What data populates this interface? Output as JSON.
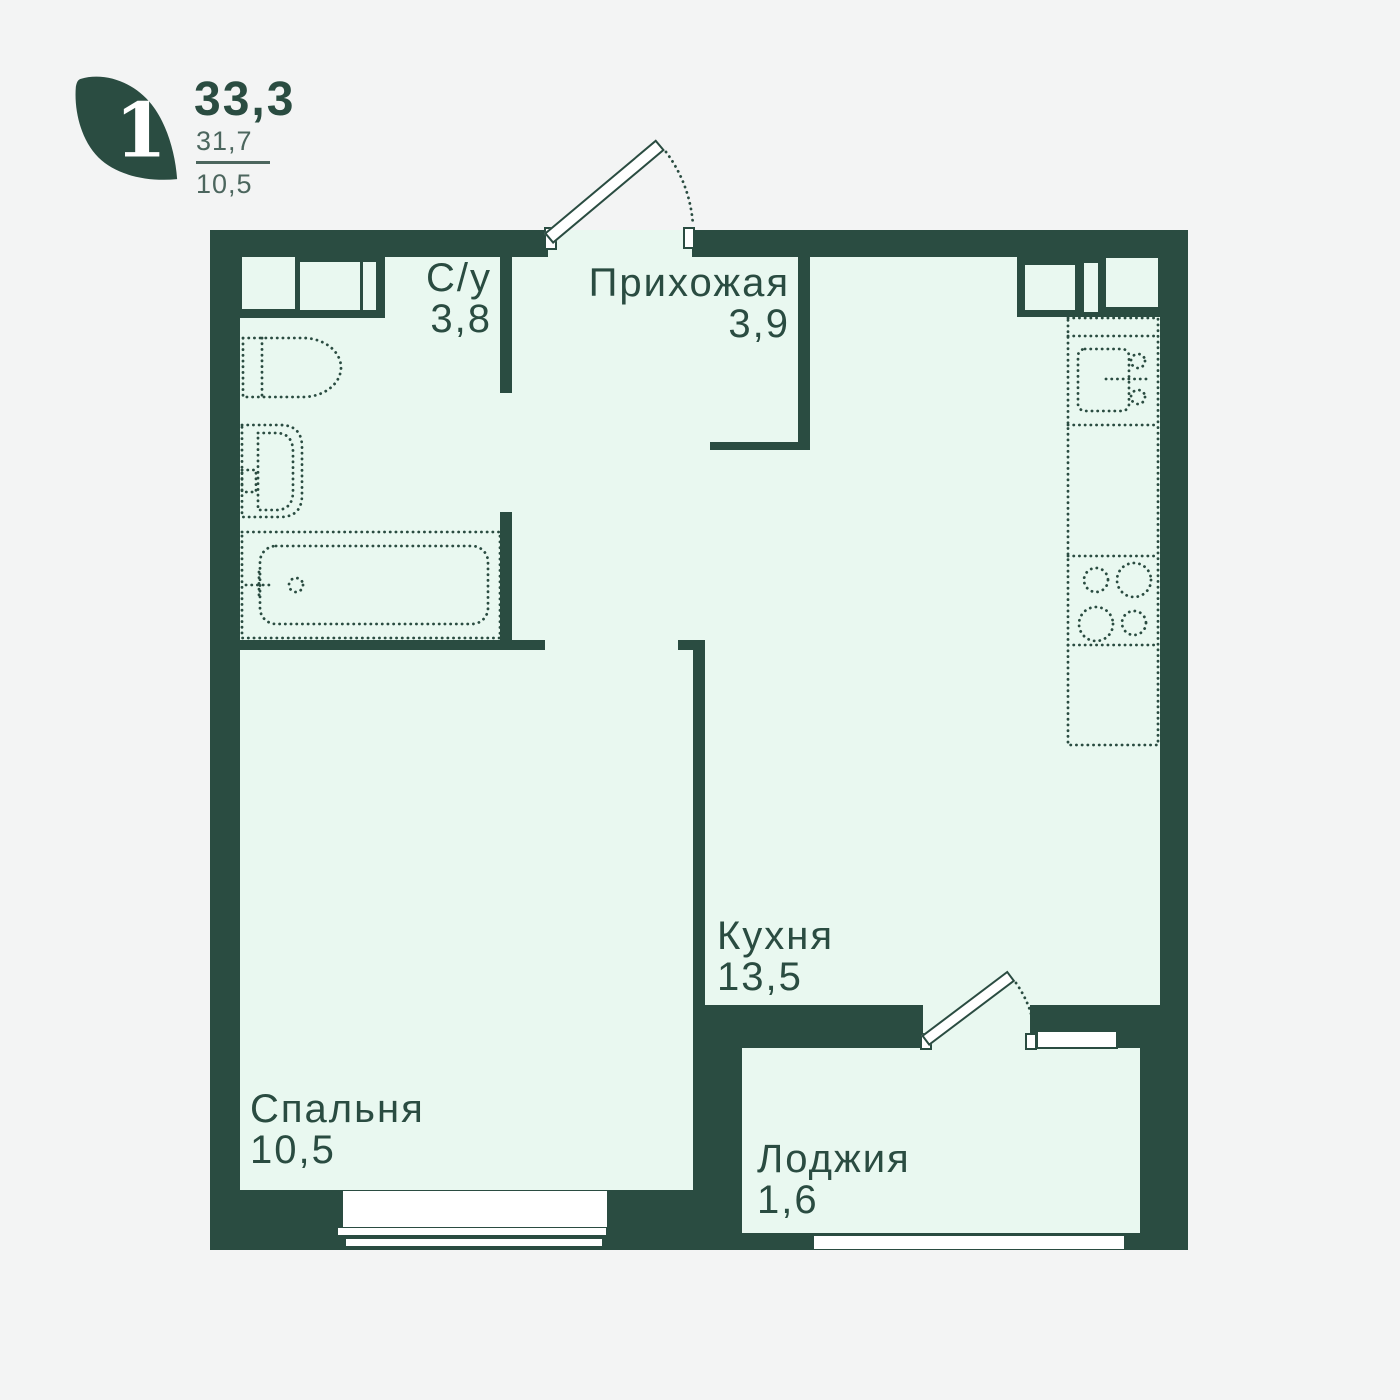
{
  "unit_card": {
    "rooms_badge": "1",
    "total_area": "33,3",
    "living_area": "31,7",
    "kitchen_area": "10,5"
  },
  "rooms": [
    {
      "key": "bathroom",
      "name": "С/у",
      "area": "3,8"
    },
    {
      "key": "hallway",
      "name": "Прихожая",
      "area": "3,9"
    },
    {
      "key": "kitchen",
      "name": "Кухня",
      "area": "13,5"
    },
    {
      "key": "bedroom",
      "name": "Спальня",
      "area": "10,5"
    },
    {
      "key": "loggia",
      "name": "Лоджия",
      "area": "1,6"
    }
  ],
  "fixtures": [
    "toilet-icon",
    "bath-sink-icon",
    "bathtub-icon",
    "kitchen-counter-icon",
    "kitchen-sink-icon",
    "stove-icon",
    "entrance-door-icon",
    "balcony-door-icon",
    "bedroom-window",
    "loggia-window",
    "balcony-window"
  ],
  "colors": {
    "wall": "#2a4c41",
    "floor": "#e9f8f0",
    "background": "#f3f4f4",
    "white": "#ffffff",
    "muted": "#4c665e"
  }
}
